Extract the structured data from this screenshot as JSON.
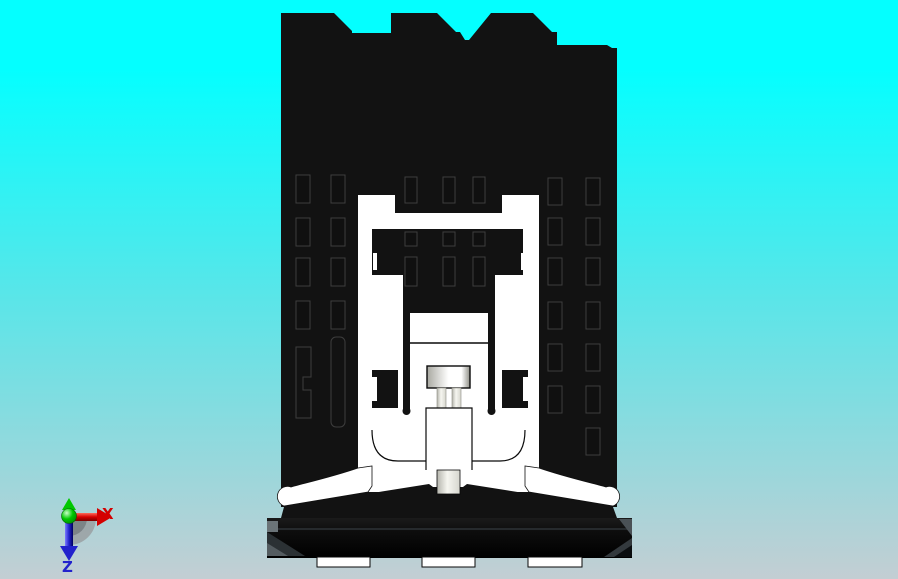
{
  "viewport": {
    "kind": "cad-3d-view"
  },
  "background": {
    "top": "#04ffff",
    "mid": "#57e6e9",
    "bottom": "#c3ced3"
  },
  "triad": {
    "x_axis": {
      "label": "X",
      "color": "#d40000"
    },
    "z_axis": {
      "label": "Z",
      "color": "#2222cc"
    },
    "y_axis": {
      "color": "#00c800"
    },
    "disc_color": "#9aa0a2"
  },
  "model": {
    "body_color": "#121212",
    "slot_fill": "#101010",
    "slot_outline": "#3d3d3d",
    "housing_color": "#ffffff",
    "knob_dark": "#a8a8a0",
    "knob_light": "#ffffff",
    "stem_color": "#d6d6ce",
    "base_color": "#0b0b0b",
    "base_highlight": "#6b7478",
    "feet_color": "#ffffff"
  }
}
